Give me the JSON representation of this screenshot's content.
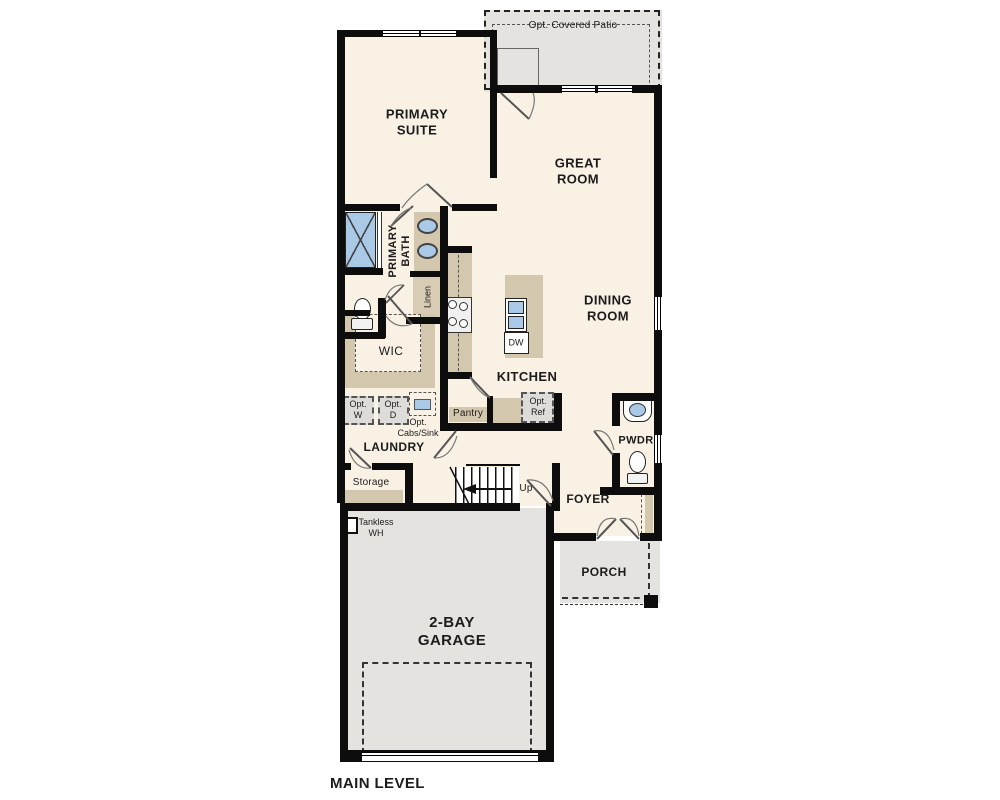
{
  "plan": {
    "name": "MAIN LEVEL",
    "colors": {
      "floor": "#F8F1E4",
      "hardscape": "#E4E3E0",
      "cabinet": "#D3C7AD",
      "fixture_blue": "#A9C9E6",
      "wall": "#0D0D0D"
    },
    "labels": {
      "patio": "Opt. Covered Patio",
      "primary_suite": "PRIMARY\nSUITE",
      "great_room": "GREAT\nROOM",
      "primary_bath": "PRIMARY\nBATH",
      "linen": "Linen",
      "wic": "WIC",
      "dining_room": "DINING\nROOM",
      "kitchen": "KITCHEN",
      "dw": "DW",
      "pantry": "Pantry",
      "opt_w": "Opt.\nW",
      "opt_d": "Opt.\nD",
      "opt_cabs_sink": "Opt.\nCabs/Sink",
      "opt_ref": "Opt.\nRef",
      "laundry": "LAUNDRY",
      "storage": "Storage",
      "up": "Up",
      "tankless_wh": "Tankless\nWH",
      "pwdr": "PWDR",
      "foyer": "FOYER",
      "porch": "PORCH",
      "garage": "2-BAY\nGARAGE",
      "main_level": "MAIN LEVEL"
    }
  }
}
